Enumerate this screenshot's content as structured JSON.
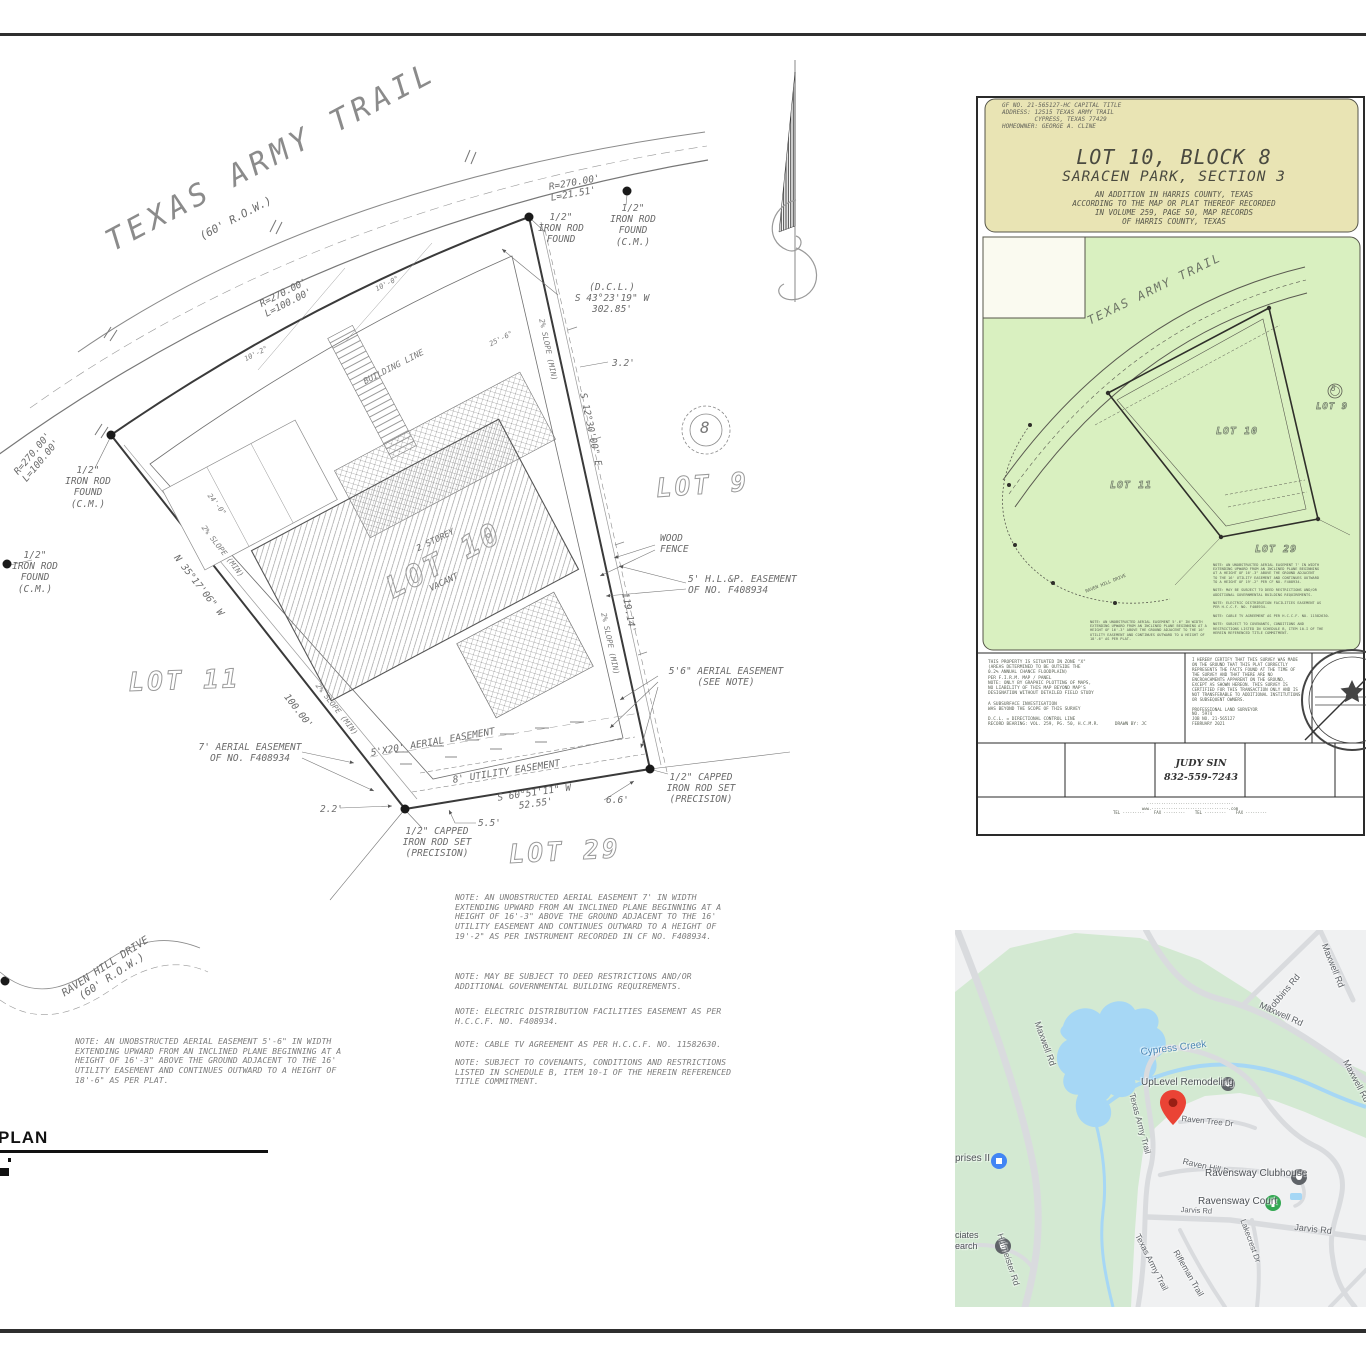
{
  "sheet": {
    "plan_label": "PLAN",
    "block_circle_number": "8"
  },
  "site_plan": {
    "labels": [
      {
        "text": "TEXAS ARMY TRAIL",
        "x": 100,
        "y": 228,
        "rot": -28,
        "size": 30,
        "cls": "roadname",
        "name": "road-name-texas-army-trail"
      },
      {
        "text": "(60' R.O.W.)",
        "x": 198,
        "y": 232,
        "rot": -28,
        "size": 11
      },
      {
        "text": "R=270.00'\nL=100.00'",
        "x": 258,
        "y": 300,
        "rot": -27,
        "size": 9.5
      },
      {
        "text": "R=270.00'\nL=21.51'",
        "x": 548,
        "y": 182,
        "rot": -10,
        "size": 9.5
      },
      {
        "text": "1/2\"\nIRON ROD\nFOUND",
        "x": 528,
        "y": 212,
        "size": 9.5,
        "w": 66,
        "ta": "center"
      },
      {
        "text": "1/2\"\nIRON ROD\nFOUND\n(C.M.)",
        "x": 600,
        "y": 203,
        "size": 9.5,
        "w": 66,
        "ta": "center"
      },
      {
        "text": "(D.C.L.)\nS 43°23'19\" W\n302.85'",
        "x": 560,
        "y": 282,
        "size": 9.5,
        "w": 104,
        "ta": "center"
      },
      {
        "text": "R=270.00'\nL=100.00'",
        "x": 12,
        "y": 470,
        "rot": -50,
        "size": 9.5
      },
      {
        "text": "1/2\"\nIRON ROD\nFOUND\n(C.M.)",
        "x": 55,
        "y": 465,
        "size": 9.5,
        "w": 66,
        "ta": "center"
      },
      {
        "text": "1/2\"\nIRON ROD\nFOUND\n(C.M.)",
        "x": 4,
        "y": 550,
        "size": 9.5,
        "w": 62,
        "ta": "center"
      },
      {
        "text": "2% SLOPE (MIN)",
        "x": 206,
        "y": 524,
        "rot": 52,
        "size": 7.5,
        "cls": "dim"
      },
      {
        "text": "2% SLOPE (MIN)",
        "x": 545,
        "y": 318,
        "rot": 78,
        "size": 7.5,
        "cls": "dim"
      },
      {
        "text": "2% SLOPE (MIN)",
        "x": 320,
        "y": 682,
        "rot": 52,
        "size": 7.5,
        "cls": "dim"
      },
      {
        "text": "2% SLOPE (MIN)",
        "x": 607,
        "y": 612,
        "rot": 78,
        "size": 7.5,
        "cls": "dim"
      },
      {
        "text": "N 35°17'06\" W",
        "x": 180,
        "y": 553,
        "rot": 52,
        "size": 9.5
      },
      {
        "text": "100.00'",
        "x": 290,
        "y": 692,
        "rot": 52,
        "size": 9.5
      },
      {
        "text": "S 12°30'00\" E",
        "x": 588,
        "y": 392,
        "rot": 78,
        "size": 9.5
      },
      {
        "text": "119.14'",
        "x": 630,
        "y": 592,
        "rot": 79,
        "size": 9.5
      },
      {
        "text": "3.2'",
        "x": 612,
        "y": 358,
        "size": 9.5
      },
      {
        "text": "BUILDING LINE",
        "x": 362,
        "y": 378,
        "rot": -27,
        "size": 8.5,
        "cls": "dim"
      },
      {
        "text": "10'-0\"",
        "x": 374,
        "y": 286,
        "rot": -27,
        "size": 7,
        "cls": "dim"
      },
      {
        "text": "10'-2\"",
        "x": 243,
        "y": 356,
        "rot": -27,
        "size": 7,
        "cls": "dim"
      },
      {
        "text": "25'-6\"",
        "x": 488,
        "y": 341,
        "rot": -27,
        "size": 7,
        "cls": "dim"
      },
      {
        "text": "24'-0\"",
        "x": 212,
        "y": 492,
        "rot": 52,
        "size": 7,
        "cls": "dim"
      },
      {
        "text": "LOT 9",
        "x": 655,
        "y": 474,
        "rot": -4,
        "size": 26,
        "cls": "hollow",
        "name": "lot-9-label"
      },
      {
        "text": "LOT 11",
        "x": 128,
        "y": 668,
        "rot": -2,
        "size": 26,
        "cls": "hollow",
        "name": "lot-11-label"
      },
      {
        "text": "LOT 10",
        "x": 380,
        "y": 575,
        "rot": -28,
        "size": 30,
        "cls": "hollow",
        "name": "lot-10-label"
      },
      {
        "text": "LOT 29",
        "x": 508,
        "y": 840,
        "rot": -3,
        "size": 26,
        "cls": "hollow",
        "name": "lot-29-label"
      },
      {
        "text": "2 STOREY",
        "x": 415,
        "y": 545,
        "rot": -26,
        "size": 8.5
      },
      {
        "text": "VACANT",
        "x": 428,
        "y": 585,
        "rot": -26,
        "size": 8.5
      },
      {
        "text": "WOOD\nFENCE",
        "x": 660,
        "y": 533,
        "size": 9.5
      },
      {
        "text": "5' H.L.&P. EASEMENT\nOF NO. F408934",
        "x": 688,
        "y": 574,
        "size": 9.5
      },
      {
        "text": "5'6\" AERIAL EASEMENT\n(SEE NOTE)",
        "x": 660,
        "y": 666,
        "size": 9.5,
        "w": 132,
        "ta": "center"
      },
      {
        "text": "7' AERIAL EASEMENT\nOF NO. F408934",
        "x": 190,
        "y": 742,
        "size": 9.5,
        "w": 120,
        "ta": "center"
      },
      {
        "text": "5'X20' AERIAL EASEMENT",
        "x": 370,
        "y": 748,
        "rot": -10,
        "size": 9.5
      },
      {
        "text": "8' UTILITY EASEMENT",
        "x": 452,
        "y": 775,
        "rot": -9,
        "size": 9.5
      },
      {
        "text": "S 60°51'11\" W\n52.55'",
        "x": 488,
        "y": 794,
        "rot": -8,
        "size": 9.5,
        "w": 92,
        "ta": "center"
      },
      {
        "text": "5.5'",
        "x": 478,
        "y": 818,
        "size": 9.5
      },
      {
        "text": "6.6'",
        "x": 606,
        "y": 795,
        "size": 9.5
      },
      {
        "text": "2.2'",
        "x": 320,
        "y": 804,
        "size": 9.5
      },
      {
        "text": "1/2\" CAPPED\nIRON ROD SET\n(PRECISION)",
        "x": 652,
        "y": 772,
        "size": 9.5,
        "w": 98,
        "ta": "center"
      },
      {
        "text": "1/2\" CAPPED\nIRON ROD SET\n(PRECISION)",
        "x": 388,
        "y": 826,
        "size": 9.5,
        "w": 98,
        "ta": "center"
      },
      {
        "text": "8",
        "x": 700,
        "y": 419,
        "size": 16,
        "cls": "dim",
        "name": "block-number"
      },
      {
        "text": "RAVEN HILL DRIVE\n(60' R.O.W.)",
        "x": 55,
        "y": 992,
        "rot": -33,
        "size": 10.5,
        "w": 112,
        "ta": "center",
        "name": "road-name-raven-hill"
      },
      {
        "text": "NOTE: AN UNOBSTRUCTED AERIAL EASEMENT 7' IN WIDTH\nEXTENDING UPWARD FROM AN INCLINED PLANE BEGINNING AT A\nHEIGHT OF 16'-3\" ABOVE THE GROUND ADJACENT TO THE 16'\nUTILITY EASEMENT AND CONTINUES OUTWARD TO A HEIGHT OF\n19'-2\" AS PER INSTRUMENT RECORDED IN CF NO. F408934.",
        "x": 455,
        "y": 893,
        "size": 8.2,
        "cls": "note",
        "name": "note-aerial-easement-7ft"
      },
      {
        "text": "NOTE: MAY BE SUBJECT TO DEED RESTRICTIONS AND/OR\nADDITIONAL GOVERNMENTAL BUILDING REQUIREMENTS.",
        "x": 455,
        "y": 972,
        "size": 8.2,
        "cls": "note",
        "name": "note-deed-restrictions"
      },
      {
        "text": "NOTE: ELECTRIC DISTRIBUTION FACILITIES EASEMENT AS PER\nH.C.C.F. NO. F408934.",
        "x": 455,
        "y": 1007,
        "size": 8.2,
        "cls": "note",
        "name": "note-electric-easement"
      },
      {
        "text": "NOTE: CABLE TV AGREEMENT AS PER H.C.C.F. NO. 11582630.",
        "x": 455,
        "y": 1040,
        "size": 8.2,
        "cls": "note",
        "name": "note-cable-tv"
      },
      {
        "text": "NOTE: SUBJECT TO COVENANTS, CONDITIONS AND RESTRICTIONS\nLISTED IN SCHEDULE B, ITEM 10-I OF THE HEREIN REFERENCED\nTITLE COMMITMENT.",
        "x": 455,
        "y": 1058,
        "size": 8.2,
        "cls": "note",
        "name": "note-covenants"
      },
      {
        "text": "NOTE: AN UNOBSTRUCTED AERIAL EASEMENT 5'-6\" IN WIDTH\nEXTENDING UPWARD FROM AN INCLINED PLANE BEGINNING AT A\nHEIGHT OF 16'-3\" ABOVE THE GROUND ADJACENT TO THE 16'\nUTILITY EASEMENT AND CONTINUES OUTWARD TO A HEIGHT OF\n18'-6\" AS PER PLAT.",
        "x": 75,
        "y": 1037,
        "size": 8.2,
        "cls": "note",
        "name": "note-aerial-easement-5ft6"
      }
    ]
  },
  "document": {
    "labels": [
      {
        "text": "GF NO. 21-565127-HC CAPITAL TITLE\nADDRESS: 12515 TEXAS ARMY TRAIL\n         CYPRESS, TEXAS 77429\nHOMEOWNER: GEORGE A. CLINE",
        "x": 1002,
        "y": 102,
        "size": 6,
        "cls": "dochead",
        "name": "doc-gf-number-block"
      },
      {
        "text": "LOT 10, BLOCK 8",
        "x": 985,
        "y": 146,
        "w": 378,
        "ta": "center",
        "size": 20,
        "cls": "doctitle",
        "name": "doc-title"
      },
      {
        "text": "SARACEN PARK, SECTION 3",
        "x": 985,
        "y": 169,
        "w": 378,
        "ta": "center",
        "size": 14.5,
        "cls": "doctitle",
        "name": "doc-subtitle"
      },
      {
        "text": "AN ADDITION IN HARRIS COUNTY, TEXAS\nACCORDING TO THE MAP OR PLAT THEREOF RECORDED\nIN VOLUME 259, PAGE 50, MAP RECORDS\nOF HARRIS COUNTY, TEXAS",
        "x": 985,
        "y": 191,
        "w": 378,
        "ta": "center",
        "size": 7.5,
        "cls": "docsub",
        "name": "doc-recording-info"
      },
      {
        "text": "TEXAS ARMY TRAIL",
        "x": 1085,
        "y": 315,
        "rot": -26,
        "size": 12,
        "cls": "doctrail"
      },
      {
        "text": "LOT 10",
        "x": 1216,
        "y": 426,
        "size": 10,
        "cls": "hollow2"
      },
      {
        "text": "LOT 11",
        "x": 1110,
        "y": 480,
        "size": 10,
        "cls": "hollow2"
      },
      {
        "text": "LOT 9",
        "x": 1316,
        "y": 402,
        "size": 9,
        "cls": "hollow2"
      },
      {
        "text": "LOT 29",
        "x": 1255,
        "y": 544,
        "size": 10,
        "cls": "hollow2"
      },
      {
        "text": "8",
        "x": 1331,
        "y": 384,
        "size": 8,
        "cls": "doctrail"
      },
      {
        "text": "RAVEN HILL DRIVE",
        "x": 1085,
        "y": 590,
        "rot": -22,
        "size": 4.5,
        "cls": "micro"
      },
      {
        "text": "NOTE: AN UNOBSTRUCTED AERIAL EASEMENT 7' IN WIDTH\nEXTENDING UPWARD FROM AN INCLINED PLANE BEGINNING\nAT A HEIGHT OF 16'-3\" ABOVE THE GROUND ADJACENT\nTO THE 16' UTILITY EASEMENT AND CONTINUES OUTWARD\nTO A HEIGHT OF 19'-2\" PER CF NO. F408934.\n\nNOTE: MAY BE SUBJECT TO DEED RESTRICTIONS AND/OR\nADDITIONAL GOVERNMENTAL BUILDING REQUIREMENTS.\n\nNOTE: ELECTRIC DISTRIBUTION FACILITIES EASEMENT AS\nPER H.C.C.F. NO. F408934.\n\nNOTE: CABLE TV AGREEMENT AS PER H.C.C.F. NO. 11582630.\n\nNOTE: SUBJECT TO COVENANTS, CONDITIONS AND\nRESTRICTIONS LISTED IN SCHEDULE B, ITEM 10-I OF THE\nHEREIN REFERENCED TITLE COMMITMENT.",
        "x": 1213,
        "y": 563,
        "size": 3.6,
        "cls": "micro"
      },
      {
        "text": "NOTE: AN UNOBSTRUCTED AERIAL EASEMENT 5'-6\" IN WIDTH\nEXTENDING UPWARD FROM AN INCLINED PLANE BEGINNING AT A\nHEIGHT OF 16'-3\" ABOVE THE GROUND ADJACENT TO THE 16'\nUTILITY EASEMENT AND CONTINUES OUTWARD TO A HEIGHT OF\n18'-6\" AS PER PLAT.",
        "x": 1090,
        "y": 620,
        "size": 3.6,
        "cls": "micro"
      },
      {
        "text": "THIS PROPERTY IS SITUATED IN ZONE \"X\"\n(AREAS DETERMINED TO BE OUTSIDE THE\n0.2% ANNUAL CHANCE FLOODPLAIN)\nPER F.I.R.M. MAP / PANEL\nNOTE: ONLY BY GRAPHIC PLOTTING OF MAPS,\nNO LIABILITY OF THIS MAP BEYOND MAP'S\nDESIGNATION WITHOUT DETAILED FIELD STUDY\n\nA SUBSURFACE INVESTIGATION\nWAS BEYOND THE SCOPE OF THIS SURVEY\n\nD.C.L. = DIRECTIONAL CONTROL LINE\nRECORD BEARING: VOL. 259, PG. 50, H.C.M.R.      DRAWN BY: JC",
        "x": 988,
        "y": 660,
        "size": 4.4,
        "cls": "micro",
        "name": "doc-flood-note"
      },
      {
        "text": "I HEREBY CERTIFY THAT THIS SURVEY WAS MADE\nON THE GROUND THAT THIS PLAT CORRECTLY\nREPRESENTS THE FACTS FOUND AT THE TIME OF\nTHE SURVEY AND THAT THERE ARE NO\nENCROACHMENTS APPARENT ON THE GROUND,\nEXCEPT AS SHOWN HEREON. THIS SURVEY IS\nCERTIFIED FOR THIS TRANSACTION ONLY AND IS\nNOT TRANSFERABLE TO ADDITIONAL INSTITUTIONS\nOR SUBSEQUENT OWNERS.\n\nPROFESSIONAL LAND SURVEYOR\nNO. 5974\nJOB NO. 21-565127\nFEBRUARY 2021",
        "x": 1192,
        "y": 658,
        "size": 4.2,
        "cls": "micro",
        "name": "doc-certification"
      },
      {
        "text": "JUDY SIN\n832-559-7243",
        "x": 1155,
        "y": 757,
        "w": 92,
        "ta": "center",
        "size": 9.5,
        "cls": "judy",
        "name": "doc-contact-judy-sin"
      },
      {
        "text": "····································\nwww.································.com\nTEL ····-····    FAX ····-····    TEL ····-····    FAX ····-····",
        "x": 1040,
        "y": 802,
        "w": 300,
        "ta": "center",
        "size": 4,
        "cls": "micro",
        "name": "doc-fineprint-contact"
      }
    ]
  },
  "map": {
    "labels": [
      {
        "text": "Maxwell Rd",
        "x": 1042,
        "y": 1020,
        "rot": 70,
        "size": 9
      },
      {
        "text": "Robbins Rd",
        "x": 1264,
        "y": 1008,
        "rot": -50,
        "size": 9
      },
      {
        "text": "Maxwell Rd",
        "x": 1329,
        "y": 942,
        "rot": 68,
        "size": 9
      },
      {
        "text": "Maxwell Rd",
        "x": 1262,
        "y": 1000,
        "rot": 24,
        "size": 9
      },
      {
        "text": "Maxwell Rd",
        "x": 1350,
        "y": 1058,
        "rot": 62,
        "size": 9
      },
      {
        "text": "Cypress Creek",
        "x": 1140,
        "y": 1047,
        "rot": -7,
        "size": 10,
        "cls": "water",
        "name": "map-label-cypress-creek"
      },
      {
        "text": "UpLevel Remodeling",
        "x": 1141,
        "y": 1077,
        "size": 10,
        "cls": "poi",
        "name": "map-label-uplevel-remodeling"
      },
      {
        "text": "Raven Tree Dr",
        "x": 1182,
        "y": 1114,
        "rot": 6,
        "size": 8
      },
      {
        "text": "Texas Army Trail",
        "x": 1137,
        "y": 1092,
        "rot": 75,
        "size": 8.5
      },
      {
        "text": "Texas Army Trail",
        "x": 1142,
        "y": 1232,
        "rot": 63,
        "size": 8.5
      },
      {
        "text": "Raven Hill Dr",
        "x": 1184,
        "y": 1156,
        "rot": 13,
        "size": 8.5
      },
      {
        "text": "Ravensway Clubhouse",
        "x": 1205,
        "y": 1168,
        "size": 10,
        "cls": "poi",
        "name": "map-label-ravensway-clubhouse"
      },
      {
        "text": "Ravensway Court",
        "x": 1198,
        "y": 1196,
        "size": 10,
        "cls": "poi",
        "name": "map-label-ravensway-court"
      },
      {
        "text": "Jarvis Rd",
        "x": 1181,
        "y": 1206,
        "rot": 3,
        "size": 7.5
      },
      {
        "text": "Jarvis Rd",
        "x": 1295,
        "y": 1222,
        "rot": 6,
        "size": 9
      },
      {
        "text": "Lakecrest Dr",
        "x": 1247,
        "y": 1218,
        "rot": 70,
        "size": 8
      },
      {
        "text": "Rifleman Trail",
        "x": 1180,
        "y": 1248,
        "rot": 60,
        "size": 8.5
      },
      {
        "text": "Hufmeister Rd",
        "x": 1005,
        "y": 1232,
        "rot": 72,
        "size": 8.5
      },
      {
        "text": "prises II",
        "x": 955,
        "y": 1153,
        "size": 10,
        "cls": "poi"
      },
      {
        "text": "ciates\nearch",
        "x": 955,
        "y": 1230,
        "size": 9,
        "cls": "poi"
      }
    ]
  }
}
